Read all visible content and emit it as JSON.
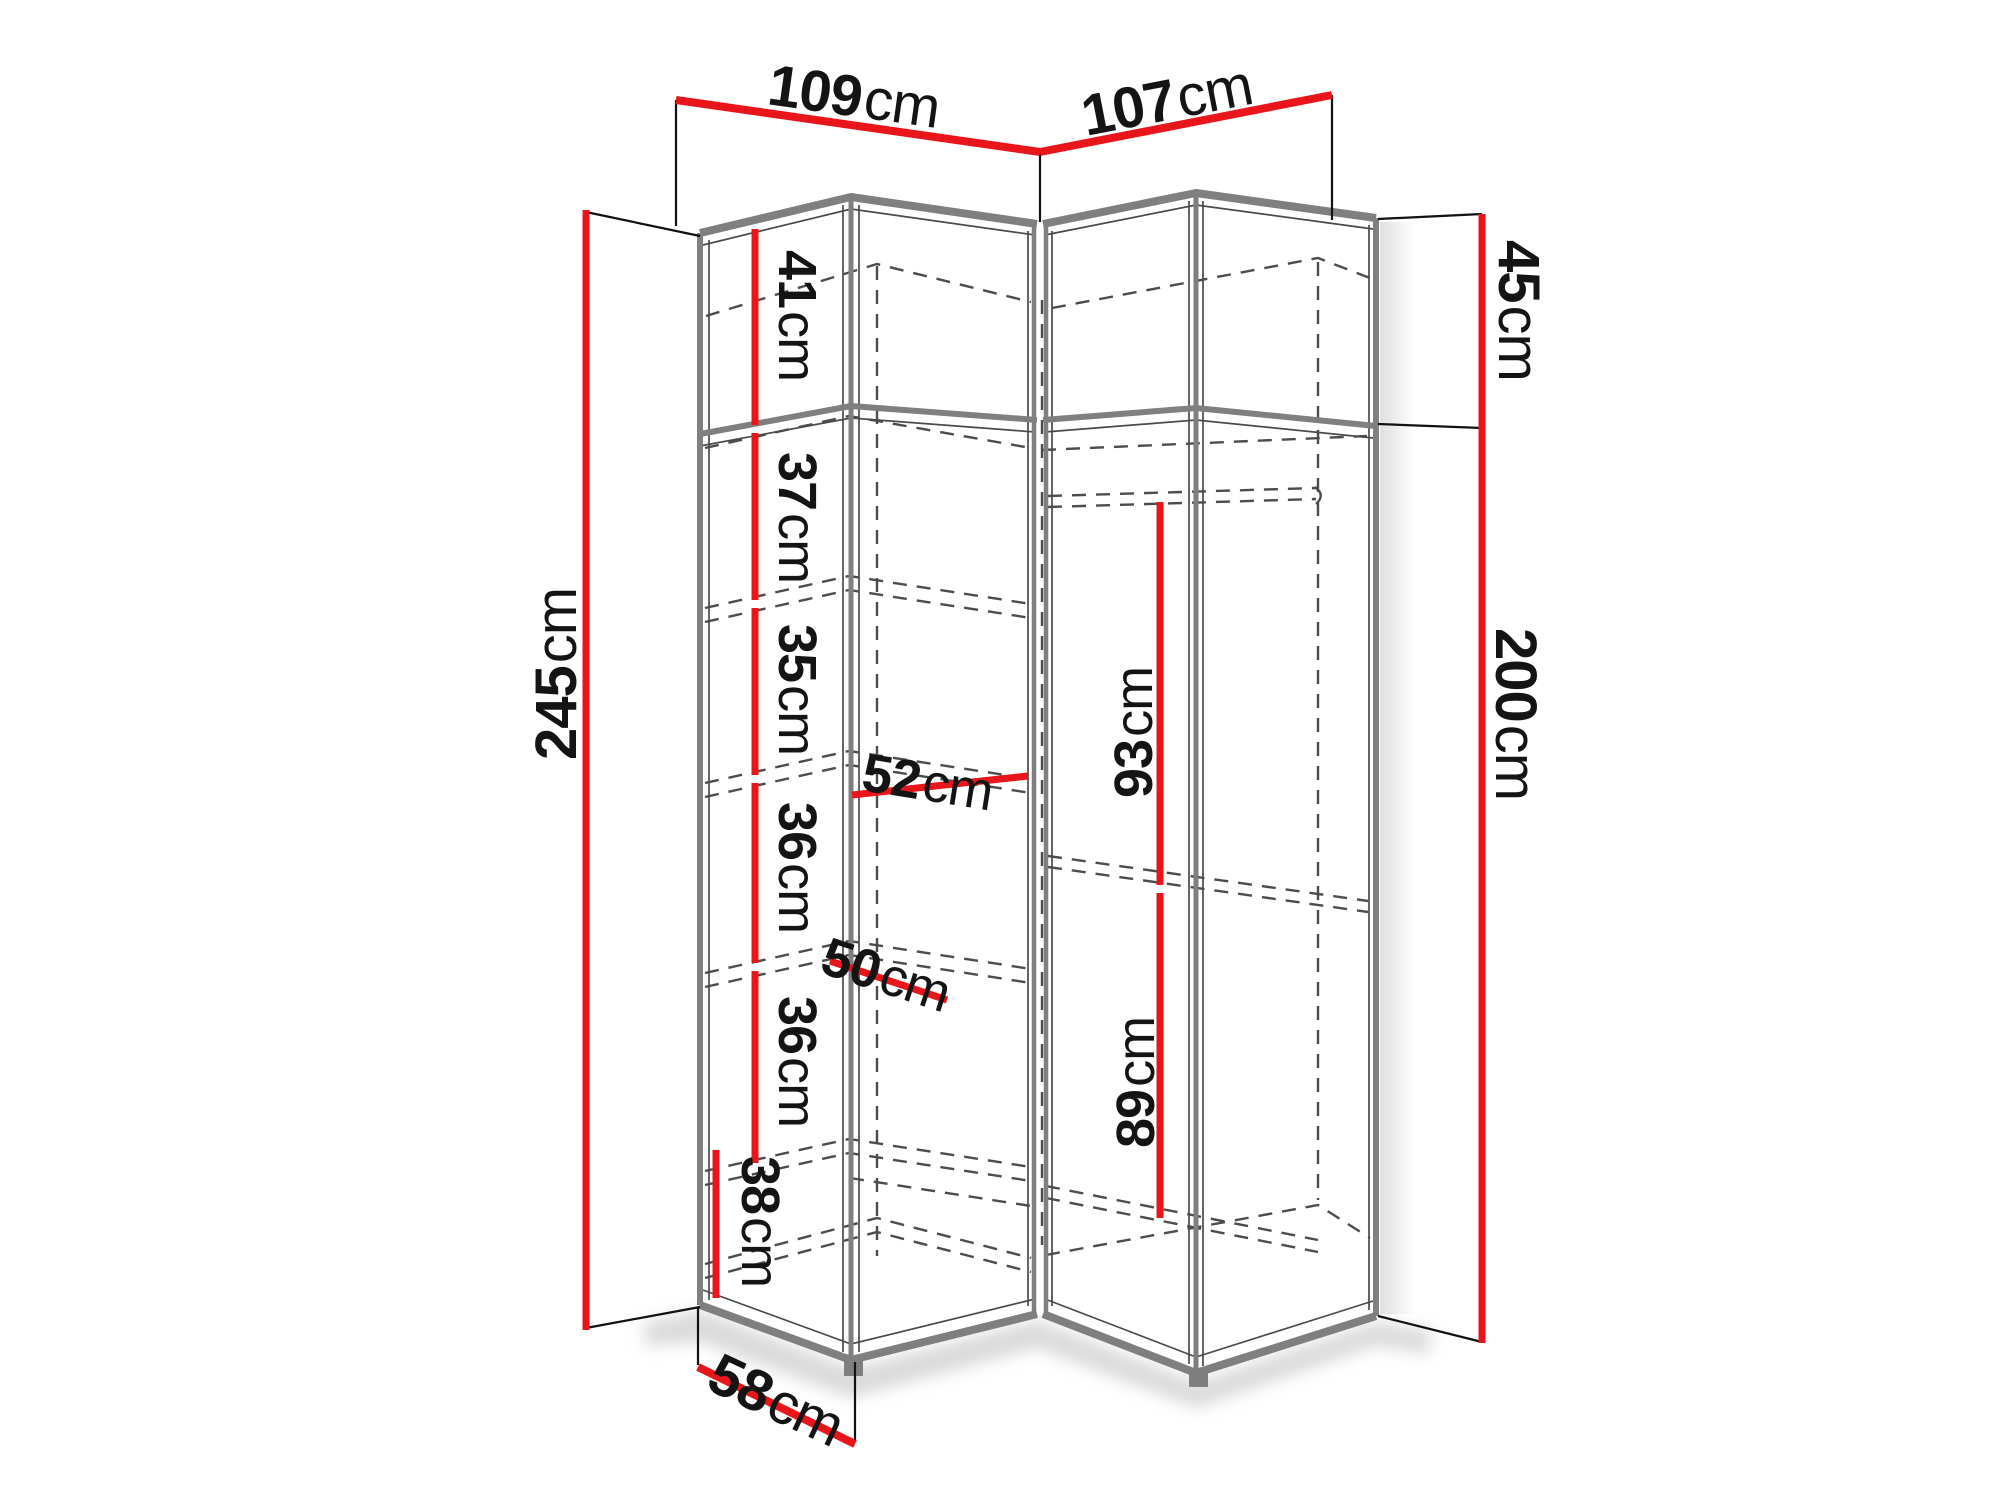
{
  "diagram": {
    "kind": "corner-wardrobe-dimension-drawing",
    "unit": "cm"
  },
  "colors": {
    "dimension_red": "#e8151b",
    "edge_gray": "#7f7f7f",
    "hidden_line_gray": "#4c4c4c",
    "text": "#141414",
    "background": "#ffffff"
  },
  "dims": {
    "top_left_width": {
      "value": "109",
      "unit": "cm"
    },
    "top_right_width": {
      "value": "107",
      "unit": "cm"
    },
    "left_total_height": {
      "value": "245",
      "unit": "cm"
    },
    "right_top_height": {
      "value": "45",
      "unit": "cm"
    },
    "right_lower_height": {
      "value": "200",
      "unit": "cm"
    },
    "bottom_depth": {
      "value": "58",
      "unit": "cm"
    },
    "sec41": {
      "value": "41",
      "unit": "cm"
    },
    "sec37": {
      "value": "37",
      "unit": "cm"
    },
    "sec35": {
      "value": "35",
      "unit": "cm"
    },
    "sec36a": {
      "value": "36",
      "unit": "cm"
    },
    "sec36b": {
      "value": "36",
      "unit": "cm"
    },
    "sec38": {
      "value": "38",
      "unit": "cm"
    },
    "shelf52": {
      "value": "52",
      "unit": "cm"
    },
    "shelf50": {
      "value": "50",
      "unit": "cm"
    },
    "rod93": {
      "value": "93",
      "unit": "cm"
    },
    "rod89": {
      "value": "89",
      "unit": "cm"
    }
  }
}
